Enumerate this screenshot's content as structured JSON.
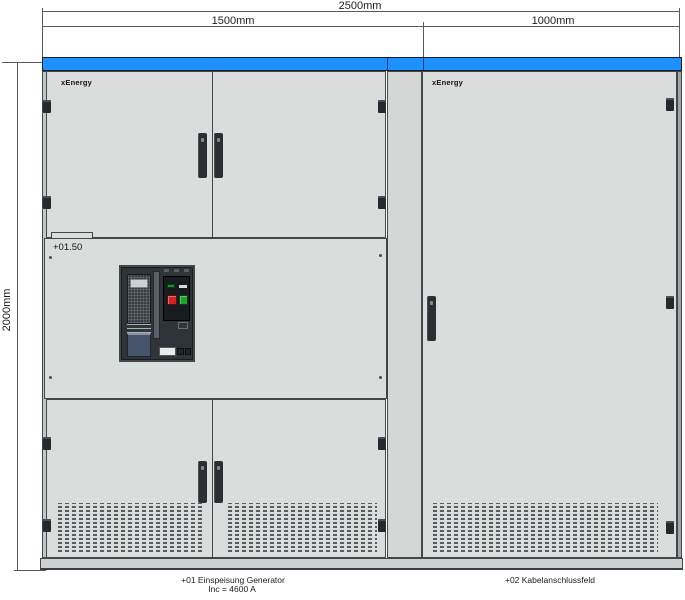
{
  "dims": {
    "total": "2500mm",
    "left": "1500mm",
    "right": "1000mm",
    "height": "2000mm"
  },
  "left_cabinet": {
    "brand": "xEnergy",
    "panel_label": "+01.50",
    "caption_line1": "+01 Einspeisung Generator",
    "caption_line2": "Inc = 4600 A"
  },
  "right_cabinet": {
    "brand": "xEnergy",
    "caption": "+02 Kabelanschlussfeld"
  },
  "colors": {
    "canopy_blue": "#1E90FF",
    "door_gray": "#D9DDDC",
    "outline": "#42474B",
    "breaker_frame": "#2F3438",
    "breaker_control_panel": "#191C1F",
    "off_button_red": "#D32222",
    "on_button_green": "#1FA32F",
    "racking_box_blue_gray": "#46546B"
  }
}
